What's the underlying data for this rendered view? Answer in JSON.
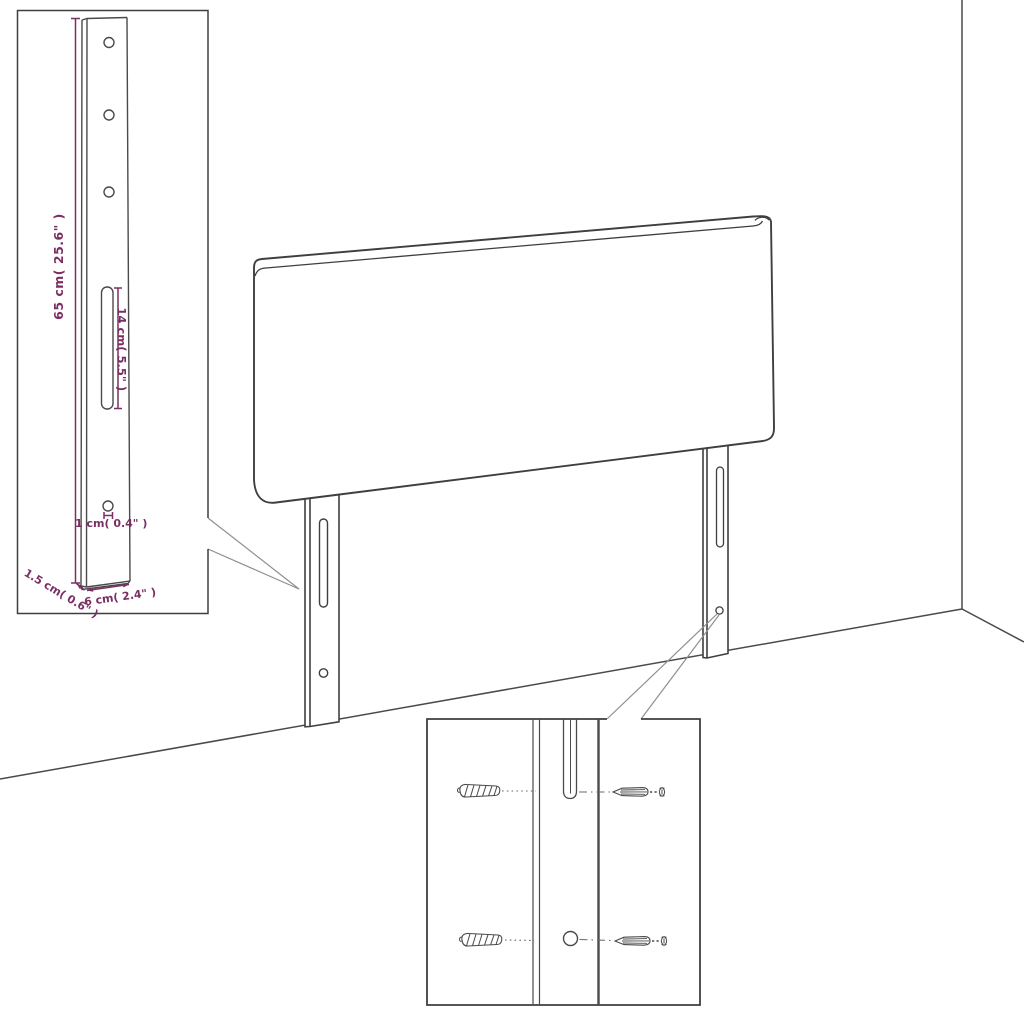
{
  "diagram": {
    "dimensions": {
      "leg_height": "65 cm( 25.6\" )",
      "slot_length": "14 cm( 5.5\" )",
      "hole_size": "1 cm( 0.4\" )",
      "leg_depth": "1.5 cm( 0.6\" )",
      "leg_width": "6 cm( 2.4\" )"
    },
    "colors": {
      "dimension_text": "#7a2f63",
      "line_art": "#3f3f3f",
      "background": "#ffffff"
    }
  }
}
